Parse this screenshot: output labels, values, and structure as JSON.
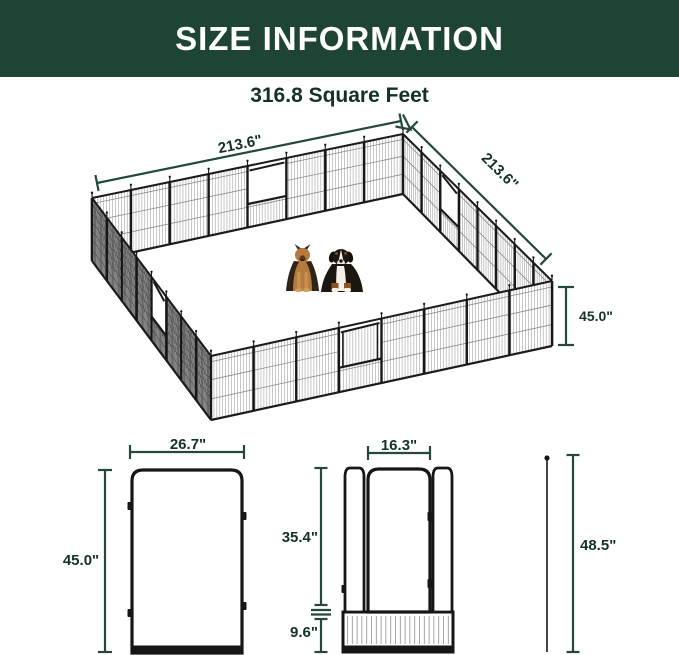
{
  "header": {
    "title": "SIZE INFORMATION"
  },
  "diagram": {
    "subtitle": "316.8 Square Feet",
    "pen": {
      "width_label": "213.6\"",
      "depth_label": "213.6\"",
      "height_label": "45.0\""
    },
    "panel": {
      "width_label": "26.7\"",
      "height_label": "45.0\""
    },
    "door_panel": {
      "door_width_label": "16.3\"",
      "upper_height_label": "35.4\"",
      "bottom_height_label": "9.6\""
    },
    "stake": {
      "height_label": "48.5\""
    }
  },
  "colors": {
    "banner_green": "#1e4434",
    "dimension_green": "#24493b",
    "label_dark": "#14302a",
    "fence_black": "#171717"
  }
}
